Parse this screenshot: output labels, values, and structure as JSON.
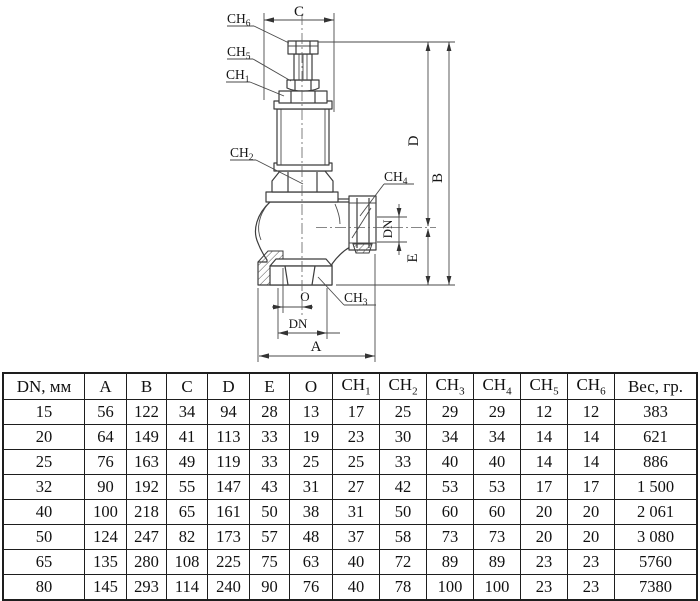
{
  "diagram": {
    "labels": {
      "ch6": {
        "base": "CH",
        "sub": "6"
      },
      "ch5": {
        "base": "CH",
        "sub": "5"
      },
      "ch1": {
        "base": "CH",
        "sub": "1"
      },
      "ch2": {
        "base": "CH",
        "sub": "2"
      },
      "ch4": {
        "base": "CH",
        "sub": "4"
      },
      "ch3": {
        "base": "CH",
        "sub": "3"
      }
    },
    "dims": {
      "c": "C",
      "d": "D",
      "b": "B",
      "e": "E",
      "dn_outlet": "DN",
      "o": "O",
      "dn_inlet": "DN",
      "a": "A"
    }
  },
  "table": {
    "headers": [
      {
        "t": "DN, мм"
      },
      {
        "t": "A"
      },
      {
        "t": "B"
      },
      {
        "t": "C"
      },
      {
        "t": "D"
      },
      {
        "t": "E"
      },
      {
        "t": "O"
      },
      {
        "t": "CH",
        "sub": "1"
      },
      {
        "t": "CH",
        "sub": "2"
      },
      {
        "t": "CH",
        "sub": "3"
      },
      {
        "t": "CH",
        "sub": "4"
      },
      {
        "t": "CH",
        "sub": "5"
      },
      {
        "t": "CH",
        "sub": "6"
      },
      {
        "t": "Вес, гр."
      }
    ],
    "rows": [
      [
        "15",
        "56",
        "122",
        "34",
        "94",
        "28",
        "13",
        "17",
        "25",
        "29",
        "29",
        "12",
        "12",
        "383"
      ],
      [
        "20",
        "64",
        "149",
        "41",
        "113",
        "33",
        "19",
        "23",
        "30",
        "34",
        "34",
        "14",
        "14",
        "621"
      ],
      [
        "25",
        "76",
        "163",
        "49",
        "119",
        "33",
        "25",
        "25",
        "33",
        "40",
        "40",
        "14",
        "14",
        "886"
      ],
      [
        "32",
        "90",
        "192",
        "55",
        "147",
        "43",
        "31",
        "27",
        "42",
        "53",
        "53",
        "17",
        "17",
        "1 500"
      ],
      [
        "40",
        "100",
        "218",
        "65",
        "161",
        "50",
        "38",
        "31",
        "50",
        "60",
        "60",
        "20",
        "20",
        "2 061"
      ],
      [
        "50",
        "124",
        "247",
        "82",
        "173",
        "57",
        "48",
        "37",
        "58",
        "73",
        "73",
        "20",
        "20",
        "3 080"
      ],
      [
        "65",
        "135",
        "280",
        "108",
        "225",
        "75",
        "63",
        "40",
        "72",
        "89",
        "89",
        "23",
        "23",
        "5760"
      ],
      [
        "80",
        "145",
        "293",
        "114",
        "240",
        "90",
        "76",
        "40",
        "78",
        "100",
        "100",
        "23",
        "23",
        "7380"
      ]
    ]
  },
  "colors": {
    "line": "#3c3c3c",
    "text": "#161616",
    "background": "#ffffff"
  }
}
